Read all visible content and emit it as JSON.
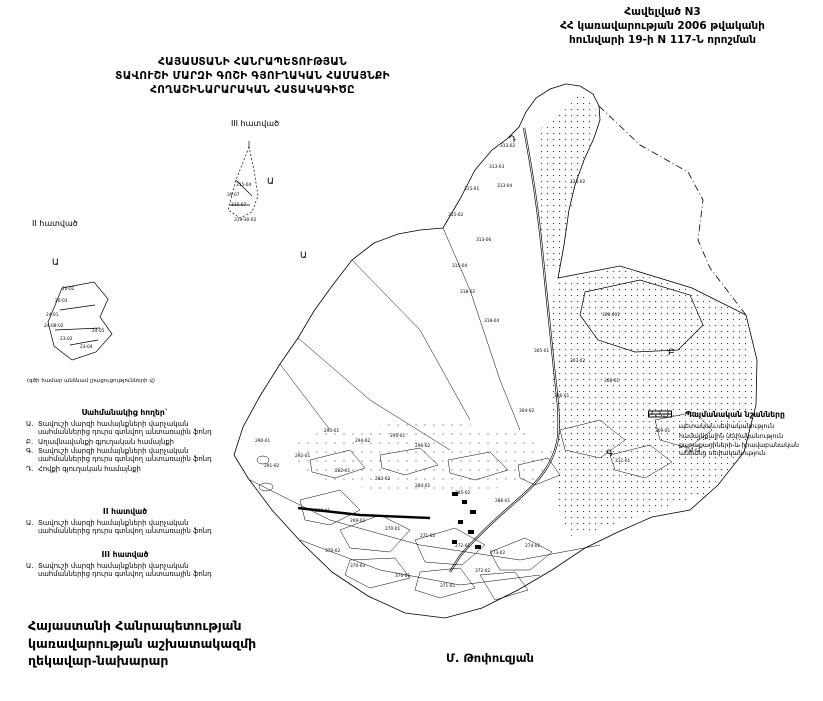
{
  "colors": {
    "ink": "#000000",
    "paper": "#ffffff",
    "stipple": "#444444"
  },
  "header": {
    "line1": "Հավելված N3",
    "line2": "ՀՀ կառավարության 2006 թվականի",
    "line3": "հունվարի 19-ի N 117-Ն որոշման"
  },
  "title": {
    "line1": "ՀԱՅԱՍՏԱՆԻ ՀԱՆՐԱՊԵՏՈՒԹՅԱՆ",
    "line2": "ՏԱՎՈՒՇԻ ՄԱՐԶԻ ԳՈՇԻ ԳՅՈՒՂԱԿԱՆ ՀԱՄԱՅՆՔԻ",
    "line3": "ՀՈՂԱՇԻՆԱՐԱՐԱԿԱՆ ՀԱՏԱԿԱԳԻԾԸ"
  },
  "note": "(գծի համար անձնամ լրացուցությունների վ)",
  "neighbors": {
    "heading": "Սահմանակից հողեր`",
    "items": [
      {
        "marker": "Ա.",
        "text": "Տավուշի մարզի համայնքների վարչական սահմաններից դուրս գտնվող անտառային ֆոնդ"
      },
      {
        "marker": "Բ.",
        "text": "Աղավնավանքի գյուղական համայնքի"
      },
      {
        "marker": "Գ.",
        "text": "Տավուշի մարզի համայնքների վարչական սահմաններից դուրս գտնվող անտառային ֆոնդ"
      },
      {
        "marker": "Դ.",
        "text": "Հովքի գյուղական համայնքի"
      }
    ]
  },
  "section2_block": {
    "heading": "II հատված",
    "items": [
      {
        "marker": "Ա.",
        "text": "Տավուշի մարզի համայնքների վարչական սահմաններից դուրս գտնվող անտառային ֆոնդ"
      }
    ]
  },
  "section3_block": {
    "heading": "III հատված",
    "items": [
      {
        "marker": "Ա.",
        "text": "Տավուշի մարզի համայնքների վարչական սահմաններից դուրս գտնվող անտառային ֆոնդ"
      }
    ]
  },
  "legend": {
    "title": "Պայմանական նշանները",
    "items": [
      {
        "symbol": "state-bar",
        "text": "պետական սեփականություն"
      },
      {
        "symbol": "community-dots",
        "text": "համայնքային սեփականություն"
      },
      {
        "symbol": "citizen-dots",
        "text": "քաղաքացիների և իրավաբանական անձանց սեփականություն"
      }
    ]
  },
  "footer": {
    "line1": "Հայաստանի Հանրապետության",
    "line2": "կառավարության աշխատակազմի",
    "line3": "ղեկավար-նախարար",
    "signature": "Մ. Թոփուզյան"
  },
  "map": {
    "letters": [
      {
        "t": "Ա",
        "x": 300,
        "y": 258
      },
      {
        "t": "Դ",
        "x": 509,
        "y": 142
      },
      {
        "t": "Բ",
        "x": 668,
        "y": 355
      },
      {
        "t": "Գ",
        "x": 606,
        "y": 456
      }
    ],
    "parcel_labels": [
      {
        "t": "313-02",
        "x": 500,
        "y": 147
      },
      {
        "t": "313-03",
        "x": 489,
        "y": 168
      },
      {
        "t": "315-01",
        "x": 464,
        "y": 190
      },
      {
        "t": "313-04",
        "x": 497,
        "y": 187
      },
      {
        "t": "315-02",
        "x": 448,
        "y": 216
      },
      {
        "t": "313-06",
        "x": 476,
        "y": 241
      },
      {
        "t": "225-02",
        "x": 570,
        "y": 183
      },
      {
        "t": "315-04",
        "x": 452,
        "y": 267
      },
      {
        "t": "318-02",
        "x": 460,
        "y": 293
      },
      {
        "t": "308-001",
        "x": 602,
        "y": 316
      },
      {
        "t": "318-04",
        "x": 484,
        "y": 322
      },
      {
        "t": "305-01",
        "x": 534,
        "y": 352
      },
      {
        "t": "307-02",
        "x": 570,
        "y": 362
      },
      {
        "t": "308-01",
        "x": 604,
        "y": 382
      },
      {
        "t": "306-01",
        "x": 554,
        "y": 397
      },
      {
        "t": "304-02",
        "x": 519,
        "y": 412
      },
      {
        "t": "293-01",
        "x": 324,
        "y": 432
      },
      {
        "t": "294-02",
        "x": 355,
        "y": 442
      },
      {
        "t": "295-01",
        "x": 390,
        "y": 437
      },
      {
        "t": "296-02",
        "x": 415,
        "y": 447
      },
      {
        "t": "292-01",
        "x": 295,
        "y": 457
      },
      {
        "t": "291-02",
        "x": 264,
        "y": 467
      },
      {
        "t": "282-01",
        "x": 335,
        "y": 472
      },
      {
        "t": "283-02",
        "x": 375,
        "y": 480
      },
      {
        "t": "284-01",
        "x": 415,
        "y": 487
      },
      {
        "t": "285-02",
        "x": 455,
        "y": 494
      },
      {
        "t": "286-01",
        "x": 495,
        "y": 502
      },
      {
        "t": "268-01",
        "x": 315,
        "y": 512
      },
      {
        "t": "269-02",
        "x": 350,
        "y": 522
      },
      {
        "t": "270-01",
        "x": 385,
        "y": 530
      },
      {
        "t": "271-02",
        "x": 420,
        "y": 537
      },
      {
        "t": "272-01",
        "x": 455,
        "y": 547
      },
      {
        "t": "273-02",
        "x": 490,
        "y": 554
      },
      {
        "t": "274-01",
        "x": 525,
        "y": 547
      },
      {
        "t": "370-02",
        "x": 325,
        "y": 552
      },
      {
        "t": "370-03",
        "x": 350,
        "y": 567
      },
      {
        "t": "370-01",
        "x": 395,
        "y": 577
      },
      {
        "t": "371-01",
        "x": 440,
        "y": 587
      },
      {
        "t": "372-02",
        "x": 475,
        "y": 572
      },
      {
        "t": "309-01",
        "x": 655,
        "y": 432
      },
      {
        "t": "310-02",
        "x": 685,
        "y": 452
      },
      {
        "t": "311-01",
        "x": 615,
        "y": 462
      },
      {
        "t": "290-01",
        "x": 255,
        "y": 442
      }
    ],
    "inset2": {
      "label": "II հատված",
      "letter": {
        "t": "Ա",
        "x": 52,
        "y": 265
      },
      "labels": [
        {
          "t": "20-02",
          "x": 62,
          "y": 290
        },
        {
          "t": "20-03",
          "x": 55,
          "y": 302
        },
        {
          "t": "24-01",
          "x": 46,
          "y": 316
        },
        {
          "t": "24-08-02",
          "x": 44,
          "y": 327
        },
        {
          "t": "23-02",
          "x": 60,
          "y": 340
        },
        {
          "t": "23-04",
          "x": 80,
          "y": 348
        },
        {
          "t": "24-05",
          "x": 92,
          "y": 332
        }
      ]
    },
    "inset3": {
      "label": "III հատված",
      "letter": {
        "t": "Ա",
        "x": 267,
        "y": 184
      },
      "labels": [
        {
          "t": "315-04",
          "x": 236,
          "y": 186
        },
        {
          "t": "39-07",
          "x": 227,
          "y": 196
        },
        {
          "t": "315-07",
          "x": 231,
          "y": 206
        },
        {
          "t": "319-30-02",
          "x": 234,
          "y": 221
        }
      ]
    }
  }
}
